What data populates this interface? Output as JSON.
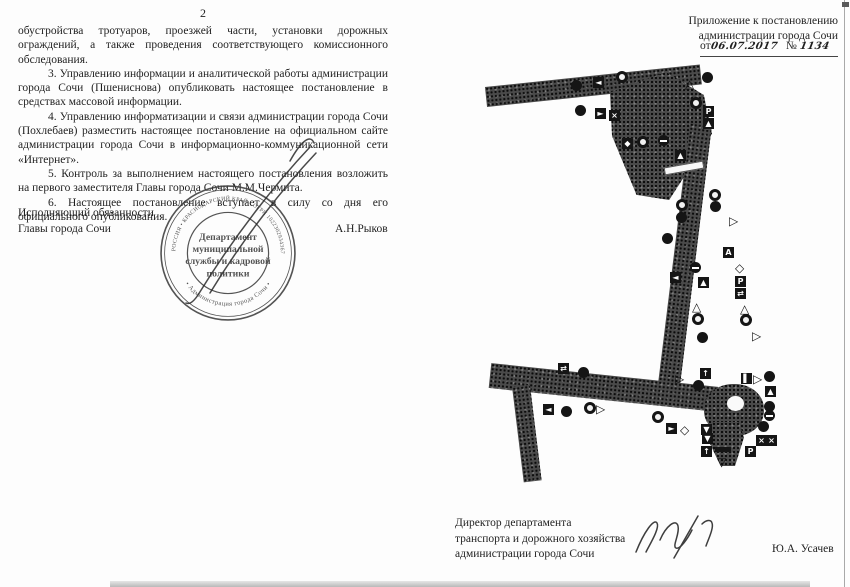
{
  "page_left": {
    "page_number": "2",
    "paragraphs": [
      "обустройства тротуаров, проезжей части, установки дорожных ограждений, а также проведения соответствующего комиссионного обследования.",
      "3. Управлению информации и аналитической работы администрации города Сочи (Пшениснова) опубликовать настоящее постановление в средствах массовой информации.",
      "4. Управлению информатизации и связи администрации города Сочи (Похлебаев) разместить настоящее постановление на официальном сайте администрации города Сочи в информационно-коммуникационной сети «Интернет».",
      "5. Контроль за выполнением настоящего постановления возложить на первого заместителя Главы города Сочи М.М.Чермита.",
      "6. Настоящее постановление вступает в силу со дня его официального опубликования."
    ],
    "signer_title_line1": "Исполняющий обязанности",
    "signer_title_line2": "Главы города Сочи",
    "signer_name": "А.Н.Рыков",
    "stamp": {
      "ring_text_top": "РОССИЯ • КРАСНОДАРСКИЙ КРАЙ • ОГРН 1022302934367",
      "ring_text_bottom": "• Администрация города Сочи •",
      "center_line1": "Департамент",
      "center_line2": "муниципальной",
      "center_line3": "службы и кадровой",
      "center_line4": "политики"
    }
  },
  "page_right": {
    "header_line1": "Приложение к постановлению",
    "header_line2": "администрации города Сочи",
    "date_prefix": "от",
    "date_value": "06.07.2017",
    "number_prefix": "№",
    "number_value": "1134",
    "footer_title_line1": "Директор департамента",
    "footer_title_line2": "транспорта и дорожного хозяйства",
    "footer_title_line3": "администрации города Сочи",
    "footer_name": "Ю.А. Усачев",
    "map": {
      "description": "схема дорожных знаков",
      "signs": [
        {
          "t": "circle",
          "x": 121,
          "y": 20
        },
        {
          "t": "sq",
          "g": "◄",
          "x": 143,
          "y": 17
        },
        {
          "t": "ring",
          "x": 166,
          "y": 11
        },
        {
          "t": "circle",
          "x": 125,
          "y": 45
        },
        {
          "t": "sq",
          "g": "►",
          "x": 145,
          "y": 48
        },
        {
          "t": "sq",
          "g": "×",
          "x": 159,
          "y": 50
        },
        {
          "t": "tri",
          "g": "△",
          "x": 235,
          "y": 18
        },
        {
          "t": "circle",
          "x": 252,
          "y": 12
        },
        {
          "t": "ring",
          "x": 240,
          "y": 37
        },
        {
          "t": "sq",
          "g": "P",
          "x": 253,
          "y": 46
        },
        {
          "t": "sq",
          "g": "▲",
          "x": 253,
          "y": 58
        },
        {
          "t": "sq",
          "g": "◆",
          "x": 172,
          "y": 78
        },
        {
          "t": "ring",
          "x": 187,
          "y": 76
        },
        {
          "t": "noentry",
          "x": 208,
          "y": 75
        },
        {
          "t": "sq",
          "g": "▲",
          "x": 225,
          "y": 90
        },
        {
          "t": "ring",
          "x": 226,
          "y": 139
        },
        {
          "t": "circle",
          "x": 226,
          "y": 152
        },
        {
          "t": "ring",
          "x": 259,
          "y": 129
        },
        {
          "t": "circle",
          "x": 260,
          "y": 141
        },
        {
          "t": "trir",
          "g": "▷",
          "x": 279,
          "y": 155
        },
        {
          "t": "circle",
          "x": 212,
          "y": 173
        },
        {
          "t": "noentry",
          "x": 240,
          "y": 202
        },
        {
          "t": "sq",
          "g": "◄",
          "x": 220,
          "y": 212
        },
        {
          "t": "sq",
          "g": "▲",
          "x": 248,
          "y": 217
        },
        {
          "t": "sq",
          "g": "A",
          "x": 273,
          "y": 187
        },
        {
          "t": "diam",
          "g": "◇",
          "x": 285,
          "y": 202
        },
        {
          "t": "sq",
          "g": "P",
          "x": 285,
          "y": 216
        },
        {
          "t": "sq",
          "g": "⇄",
          "x": 285,
          "y": 228
        },
        {
          "t": "tri",
          "g": "△",
          "x": 290,
          "y": 243
        },
        {
          "t": "ring",
          "x": 290,
          "y": 254
        },
        {
          "t": "tri",
          "g": "△",
          "x": 242,
          "y": 241
        },
        {
          "t": "ring",
          "x": 242,
          "y": 253
        },
        {
          "t": "circle",
          "x": 247,
          "y": 272
        },
        {
          "t": "trir",
          "g": "▷",
          "x": 302,
          "y": 270
        },
        {
          "t": "sq",
          "g": "⇄",
          "x": 108,
          "y": 303
        },
        {
          "t": "circle",
          "x": 128,
          "y": 307
        },
        {
          "t": "sq",
          "g": "◄",
          "x": 93,
          "y": 344
        },
        {
          "t": "circle",
          "x": 111,
          "y": 346
        },
        {
          "t": "ring",
          "x": 134,
          "y": 342
        },
        {
          "t": "trir",
          "g": "▷",
          "x": 146,
          "y": 343
        },
        {
          "t": "ring",
          "x": 202,
          "y": 351
        },
        {
          "t": "sq",
          "g": "►",
          "x": 216,
          "y": 363
        },
        {
          "t": "diam",
          "g": "◇",
          "x": 230,
          "y": 364
        },
        {
          "t": "trir",
          "g": "▷",
          "x": 225,
          "y": 313
        },
        {
          "t": "sq",
          "g": "↑",
          "x": 250,
          "y": 308
        },
        {
          "t": "circle",
          "x": 243,
          "y": 320
        },
        {
          "t": "sq",
          "g": "▌",
          "x": 291,
          "y": 313
        },
        {
          "t": "trir",
          "g": "▷",
          "x": 303,
          "y": 313
        },
        {
          "t": "circle",
          "x": 314,
          "y": 311
        },
        {
          "t": "sq",
          "g": "▲",
          "x": 315,
          "y": 326
        },
        {
          "t": "circle",
          "x": 314,
          "y": 341
        },
        {
          "t": "noentry",
          "x": 314,
          "y": 350
        },
        {
          "t": "circle",
          "x": 308,
          "y": 361
        },
        {
          "t": "sq",
          "g": "▼",
          "x": 251,
          "y": 364
        },
        {
          "t": "sq",
          "g": "▼",
          "x": 252,
          "y": 373
        },
        {
          "t": "sq",
          "g": "↑",
          "x": 251,
          "y": 386
        },
        {
          "t": "hbar",
          "x": 265,
          "y": 387
        },
        {
          "t": "trid",
          "g": "▽",
          "x": 267,
          "y": 396
        },
        {
          "t": "sq",
          "g": "P",
          "x": 295,
          "y": 386
        },
        {
          "t": "sq",
          "g": "×",
          "x": 306,
          "y": 375
        },
        {
          "t": "sq",
          "g": "×",
          "x": 316,
          "y": 375
        }
      ]
    }
  }
}
